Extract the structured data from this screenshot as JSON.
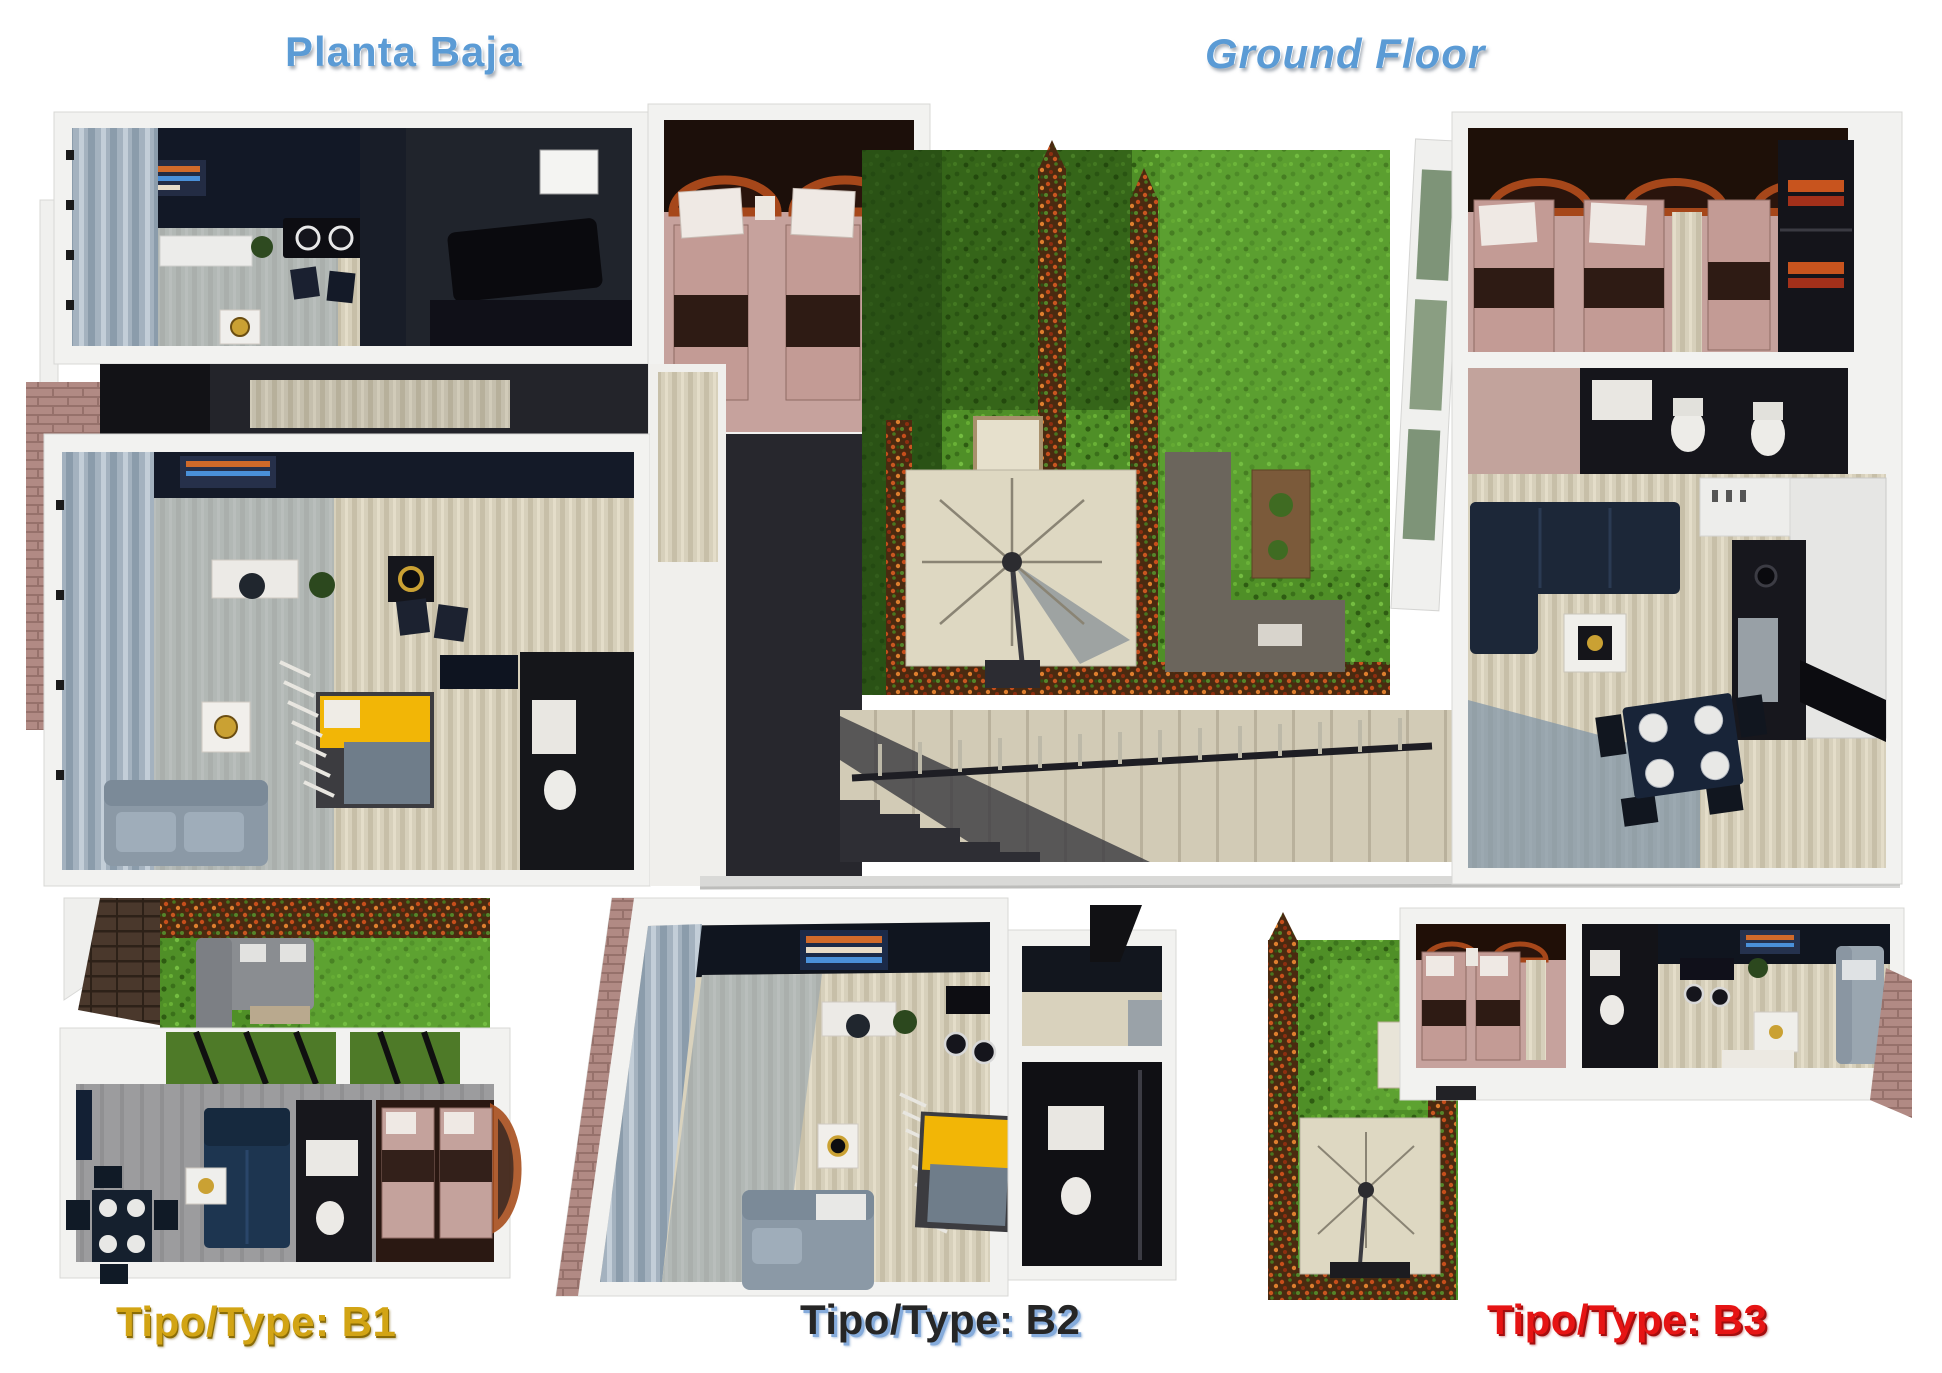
{
  "page": {
    "background": "#ffffff",
    "header": {
      "title_left": "Planta Baja",
      "title_right": "Ground Floor",
      "title_color": "#5b9bd5"
    },
    "plan_labels": {
      "b1": {
        "text": "Tipo/Type: B1",
        "color": "#d2a414"
      },
      "b2": {
        "text": "Tipo/Type: B2",
        "color": "#262626",
        "shadow_color": "#85abdb"
      },
      "b3": {
        "text": "Tipo/Type: B3",
        "color": "#e61414"
      }
    },
    "palette": {
      "title_blue": "#5b9bd5",
      "label_gold": "#d2a414",
      "label_dark": "#262626",
      "label_red": "#e61414",
      "grass_green": "#4f8f27",
      "grass_bright": "#74bd41",
      "hedge_flower_orange": "#c64e1b",
      "floor_beige": "#d7d0bb",
      "wall_white": "#f2f2f0",
      "curtain_slate": "#a4b2bf",
      "dark_navy_wall": "#10151f",
      "pink_bed": "#c6a29d",
      "blanket_brown": "#2e1b14",
      "yellow_bed": "#f2b606",
      "sofa_navy": "#1c2738",
      "sofa_gray": "#8b99a6",
      "stair_beige": "#d2cbb6",
      "brick_path": "#b18a84",
      "gold_accent": "#caa133"
    }
  }
}
